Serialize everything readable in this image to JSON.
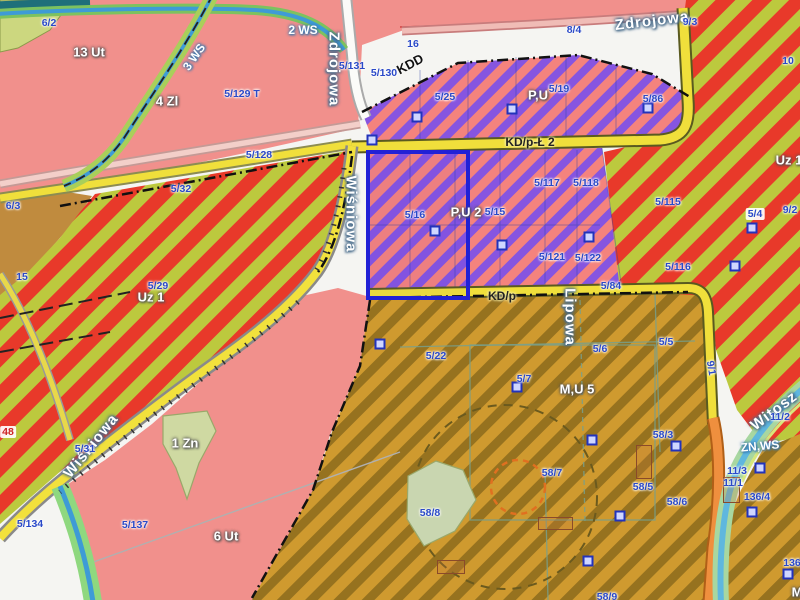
{
  "map": {
    "selection": {
      "x": 366,
      "y": 150,
      "w": 96,
      "h": 142
    },
    "labels": [
      {
        "t": "13 Ut",
        "x": 89,
        "y": 52,
        "k": "zone"
      },
      {
        "t": "6 Ut",
        "x": 226,
        "y": 536,
        "k": "zone"
      },
      {
        "t": "4 Zl",
        "x": 167,
        "y": 101,
        "k": "zone"
      },
      {
        "t": "1 Zn",
        "x": 185,
        "y": 443,
        "k": "zone"
      },
      {
        "t": "Uz 1",
        "x": 151,
        "y": 297,
        "k": "zone"
      },
      {
        "t": "Uz 1",
        "x": 789,
        "y": 160,
        "k": "zone"
      },
      {
        "t": "P,U",
        "x": 538,
        "y": 95,
        "k": "zone"
      },
      {
        "t": "P,U 2",
        "x": 466,
        "y": 212,
        "k": "zone"
      },
      {
        "t": "M,U 5",
        "x": 577,
        "y": 389,
        "k": "zone"
      },
      {
        "t": "M",
        "x": 797,
        "y": 592,
        "k": "zone"
      },
      {
        "t": "2 WS",
        "x": 303,
        "y": 30,
        "k": "zone-water"
      },
      {
        "t": "3 WS",
        "x": 194,
        "y": 57,
        "r": -55,
        "k": "zone-water"
      },
      {
        "t": "ZN,WS",
        "x": 760,
        "y": 446,
        "r": -5,
        "k": "zone-water"
      },
      {
        "t": "KDD",
        "x": 410,
        "y": 64,
        "r": -28,
        "k": "kdd"
      },
      {
        "t": "KD/p-Ł 2",
        "x": 530,
        "y": 142,
        "k": "road"
      },
      {
        "t": "KD/p",
        "x": 502,
        "y": 296,
        "k": "road"
      },
      {
        "t": "Zdrojowa",
        "x": 334,
        "y": 69,
        "r": 90,
        "k": "street"
      },
      {
        "t": "Zdrojowa",
        "x": 652,
        "y": 21,
        "r": -7,
        "k": "street"
      },
      {
        "t": "Wiśniowa",
        "x": 351,
        "y": 214,
        "r": 90,
        "k": "street"
      },
      {
        "t": "Wiśniowa",
        "x": 91,
        "y": 446,
        "r": -51,
        "k": "street"
      },
      {
        "t": "Lipowa",
        "x": 570,
        "y": 317,
        "r": 90,
        "k": "street"
      },
      {
        "t": "Witosz",
        "x": 774,
        "y": 411,
        "r": -37,
        "k": "street"
      },
      {
        "t": "6/2",
        "x": 49,
        "y": 23,
        "k": "parcel"
      },
      {
        "t": "16",
        "x": 413,
        "y": 44,
        "k": "parcel"
      },
      {
        "t": "5/131",
        "x": 352,
        "y": 66,
        "k": "parcel"
      },
      {
        "t": "5/130",
        "x": 384,
        "y": 73,
        "k": "parcel"
      },
      {
        "t": "8/4",
        "x": 574,
        "y": 30,
        "k": "parcel"
      },
      {
        "t": "9/3",
        "x": 690,
        "y": 22,
        "k": "parcel"
      },
      {
        "t": "10",
        "x": 788,
        "y": 61,
        "k": "parcel"
      },
      {
        "t": "5/25",
        "x": 445,
        "y": 97,
        "k": "parcel"
      },
      {
        "t": "5/19",
        "x": 559,
        "y": 89,
        "k": "parcel"
      },
      {
        "t": "5/86",
        "x": 653,
        "y": 99,
        "k": "parcel"
      },
      {
        "t": "5/129 T",
        "x": 242,
        "y": 94,
        "k": "parcel"
      },
      {
        "t": "5/128",
        "x": 259,
        "y": 155,
        "k": "parcel"
      },
      {
        "t": "5/32",
        "x": 181,
        "y": 189,
        "k": "parcel"
      },
      {
        "t": "6/3",
        "x": 13,
        "y": 206,
        "k": "parcel"
      },
      {
        "t": "15",
        "x": 22,
        "y": 277,
        "k": "parcel"
      },
      {
        "t": "5/29",
        "x": 158,
        "y": 286,
        "k": "parcel"
      },
      {
        "t": "5/117",
        "x": 547,
        "y": 183,
        "k": "parcel"
      },
      {
        "t": "5/118",
        "x": 586,
        "y": 183,
        "k": "parcel"
      },
      {
        "t": "5/16",
        "x": 415,
        "y": 215,
        "k": "parcel"
      },
      {
        "t": "5/15",
        "x": 495,
        "y": 212,
        "k": "parcel"
      },
      {
        "t": "5/121",
        "x": 552,
        "y": 257,
        "k": "parcel"
      },
      {
        "t": "5/122",
        "x": 588,
        "y": 258,
        "k": "parcel"
      },
      {
        "t": "5/115",
        "x": 668,
        "y": 202,
        "k": "parcel"
      },
      {
        "t": "5/4",
        "x": 755,
        "y": 214,
        "k": "parcel-pill"
      },
      {
        "t": "9/2",
        "x": 790,
        "y": 210,
        "k": "parcel"
      },
      {
        "t": "5/116",
        "x": 678,
        "y": 267,
        "k": "parcel"
      },
      {
        "t": "5/84",
        "x": 611,
        "y": 286,
        "k": "parcel"
      },
      {
        "t": "5/22",
        "x": 436,
        "y": 356,
        "k": "parcel"
      },
      {
        "t": "5/7",
        "x": 524,
        "y": 379,
        "k": "parcel"
      },
      {
        "t": "5/6",
        "x": 600,
        "y": 349,
        "k": "parcel"
      },
      {
        "t": "5/5",
        "x": 666,
        "y": 342,
        "k": "parcel"
      },
      {
        "t": "9/1",
        "x": 711,
        "y": 368,
        "r": 80,
        "k": "parcel"
      },
      {
        "t": "58/3",
        "x": 663,
        "y": 435,
        "k": "parcel"
      },
      {
        "t": "58/7",
        "x": 552,
        "y": 473,
        "k": "parcel"
      },
      {
        "t": "58/5",
        "x": 643,
        "y": 487,
        "k": "parcel"
      },
      {
        "t": "58/6",
        "x": 677,
        "y": 502,
        "k": "parcel"
      },
      {
        "t": "58/8",
        "x": 430,
        "y": 513,
        "k": "parcel"
      },
      {
        "t": "58/9",
        "x": 607,
        "y": 597,
        "k": "parcel"
      },
      {
        "t": "11/2",
        "x": 780,
        "y": 417,
        "k": "parcel"
      },
      {
        "t": "11/3",
        "x": 737,
        "y": 471,
        "k": "parcel"
      },
      {
        "t": "11/1",
        "x": 733,
        "y": 483,
        "k": "parcel"
      },
      {
        "t": "136/4",
        "x": 757,
        "y": 497,
        "k": "parcel"
      },
      {
        "t": "136",
        "x": 792,
        "y": 563,
        "k": "parcel"
      },
      {
        "t": "5/31",
        "x": 85,
        "y": 449,
        "k": "parcel"
      },
      {
        "t": "5/134",
        "x": 30,
        "y": 524,
        "k": "parcel"
      },
      {
        "t": "5/137",
        "x": 135,
        "y": 525,
        "k": "parcel"
      },
      {
        "t": "48",
        "x": 8,
        "y": 432,
        "k": "parcel-red"
      }
    ],
    "markers": [
      [
        417,
        117
      ],
      [
        512,
        109
      ],
      [
        648,
        108
      ],
      [
        372,
        140
      ],
      [
        435,
        231
      ],
      [
        502,
        245
      ],
      [
        589,
        237
      ],
      [
        752,
        228
      ],
      [
        735,
        266
      ],
      [
        380,
        344
      ],
      [
        517,
        387
      ],
      [
        592,
        440
      ],
      [
        676,
        446
      ],
      [
        760,
        468
      ],
      [
        752,
        512
      ],
      [
        788,
        574
      ],
      [
        588,
        561
      ],
      [
        620,
        516
      ]
    ],
    "buildings": [
      [
        636,
        445,
        14,
        32
      ],
      [
        538,
        517,
        33,
        11
      ],
      [
        723,
        477,
        15,
        24
      ],
      [
        437,
        560,
        26,
        12
      ]
    ],
    "palette": {
      "residential_pink": "#f1908c",
      "industry_purple": "#8655e0",
      "industry_pink": "#f4837d",
      "green_red_stripe_red": "#e8392a",
      "green_red_stripe_olive": "#bcc93e",
      "mixed_use_mustard": "#cf9a2f",
      "mixed_use_brown": "#96721f",
      "farm_tan": "#c08b3e",
      "road_yellow": "#f0df3b",
      "road_orange": "#ef8f3e",
      "water_blue": "#3e9bd6",
      "selection_blue": "#2121d6",
      "parcel_text_blue": "#2a49c8"
    }
  }
}
